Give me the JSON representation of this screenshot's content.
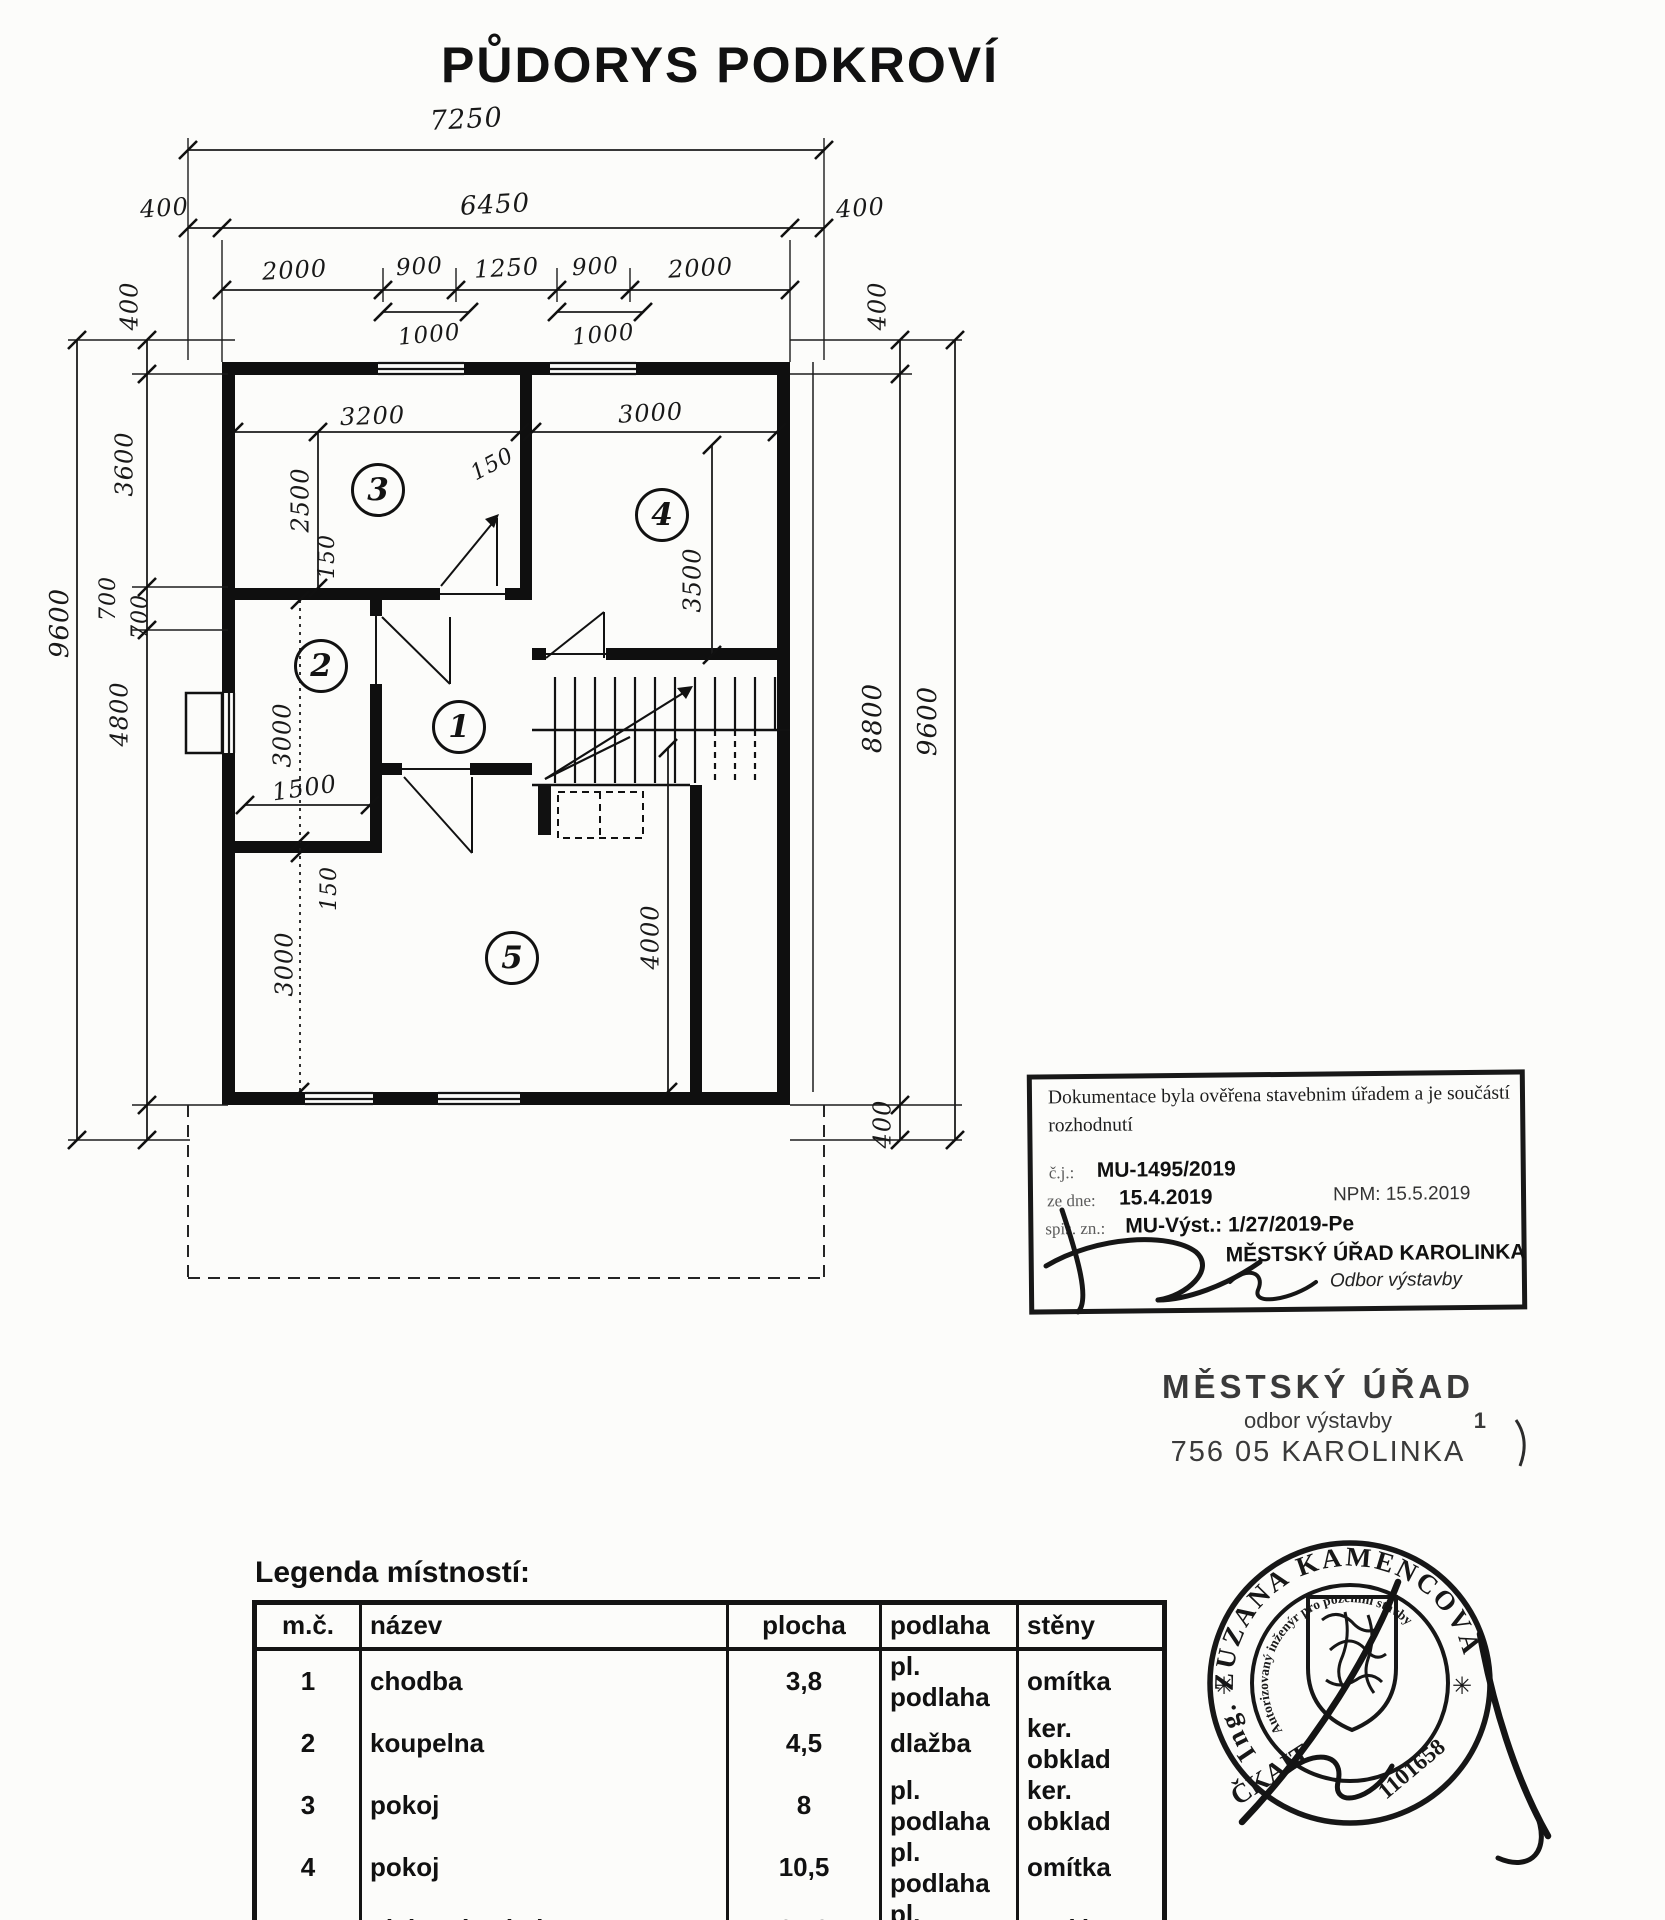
{
  "title": "PŮDORYS PODKROVÍ",
  "dims": {
    "top_total": "7250",
    "top_width": "6450",
    "top_offset_left": "400",
    "top_offset_right": "400",
    "top_segments": [
      "2000",
      "900",
      "1250",
      "900",
      "2000"
    ],
    "top_sub_left": "1000",
    "top_sub_right": "1000",
    "left_total": "9600",
    "left_top_400": "400",
    "left_3600": "3600",
    "left_700_a": "700",
    "left_700_b": "700",
    "left_4800": "4800",
    "right_top_400": "400",
    "right_span": "8800",
    "right_total": "9600",
    "right_bottom_400": "400",
    "room3_width": "3200",
    "room3_height": "2500",
    "room4_width": "3000",
    "room4_height": "3500",
    "wall_150_top": "150",
    "wall_150_mid": "150",
    "wall_150_low": "150",
    "room2_height": "3000",
    "room2_width": "1500",
    "room5_height_left": "3000",
    "room5_height_right": "4000"
  },
  "rooms": [
    "1",
    "2",
    "3",
    "4",
    "5"
  ],
  "approval_stamp": {
    "line1": "Dokumentace byla ověřena stavebnim  úřadem  a je součástí",
    "line2": "rozhodnutí",
    "cj_label": "č.j.:",
    "cj_value": "MU-1495/2019",
    "date_label": "ze dne:",
    "date_value": "15.4.2019",
    "npm": "NPM: 15.5.2019",
    "spis_label": "spis. zn.:",
    "spis_value": "MU-Výst.: 1/27/2019-Pe",
    "office": "MĚSTSKÝ ÚŘAD KAROLINKA",
    "dept": "Odbor výstavby"
  },
  "office_stamp": {
    "line1": "MĚSTSKÝ ÚŘAD",
    "line2": "odbor výstavby",
    "page_no": "1",
    "line3": "756 05 KAROLINKA"
  },
  "seal": {
    "ring_text": "Ing. ZUZANA KAMENCOVÁ",
    "star_left": "✳",
    "star_right": "✳",
    "inner_text": "Autorizovaný inženýr pro pozemní stavby",
    "org": "ČKAIT",
    "number": "1101658"
  },
  "legend": {
    "title": "Legenda místností:",
    "headers": [
      "m.č.",
      "název",
      "plocha",
      "podlaha",
      "stěny"
    ],
    "rows": [
      [
        "1",
        "chodba",
        "3,8",
        "pl. podlaha",
        "omítka"
      ],
      [
        "2",
        "koupelna",
        "4,5",
        "dlažba",
        "ker. obklad"
      ],
      [
        "3",
        "pokoj",
        "8",
        "pl. podlaha",
        "ker. obklad"
      ],
      [
        "4",
        "pokoj",
        "10,5",
        "pl. podlaha",
        "omítka"
      ],
      [
        "5",
        "obývací pokoj",
        "24,8",
        "pl. podlaha",
        "omítka"
      ]
    ]
  }
}
